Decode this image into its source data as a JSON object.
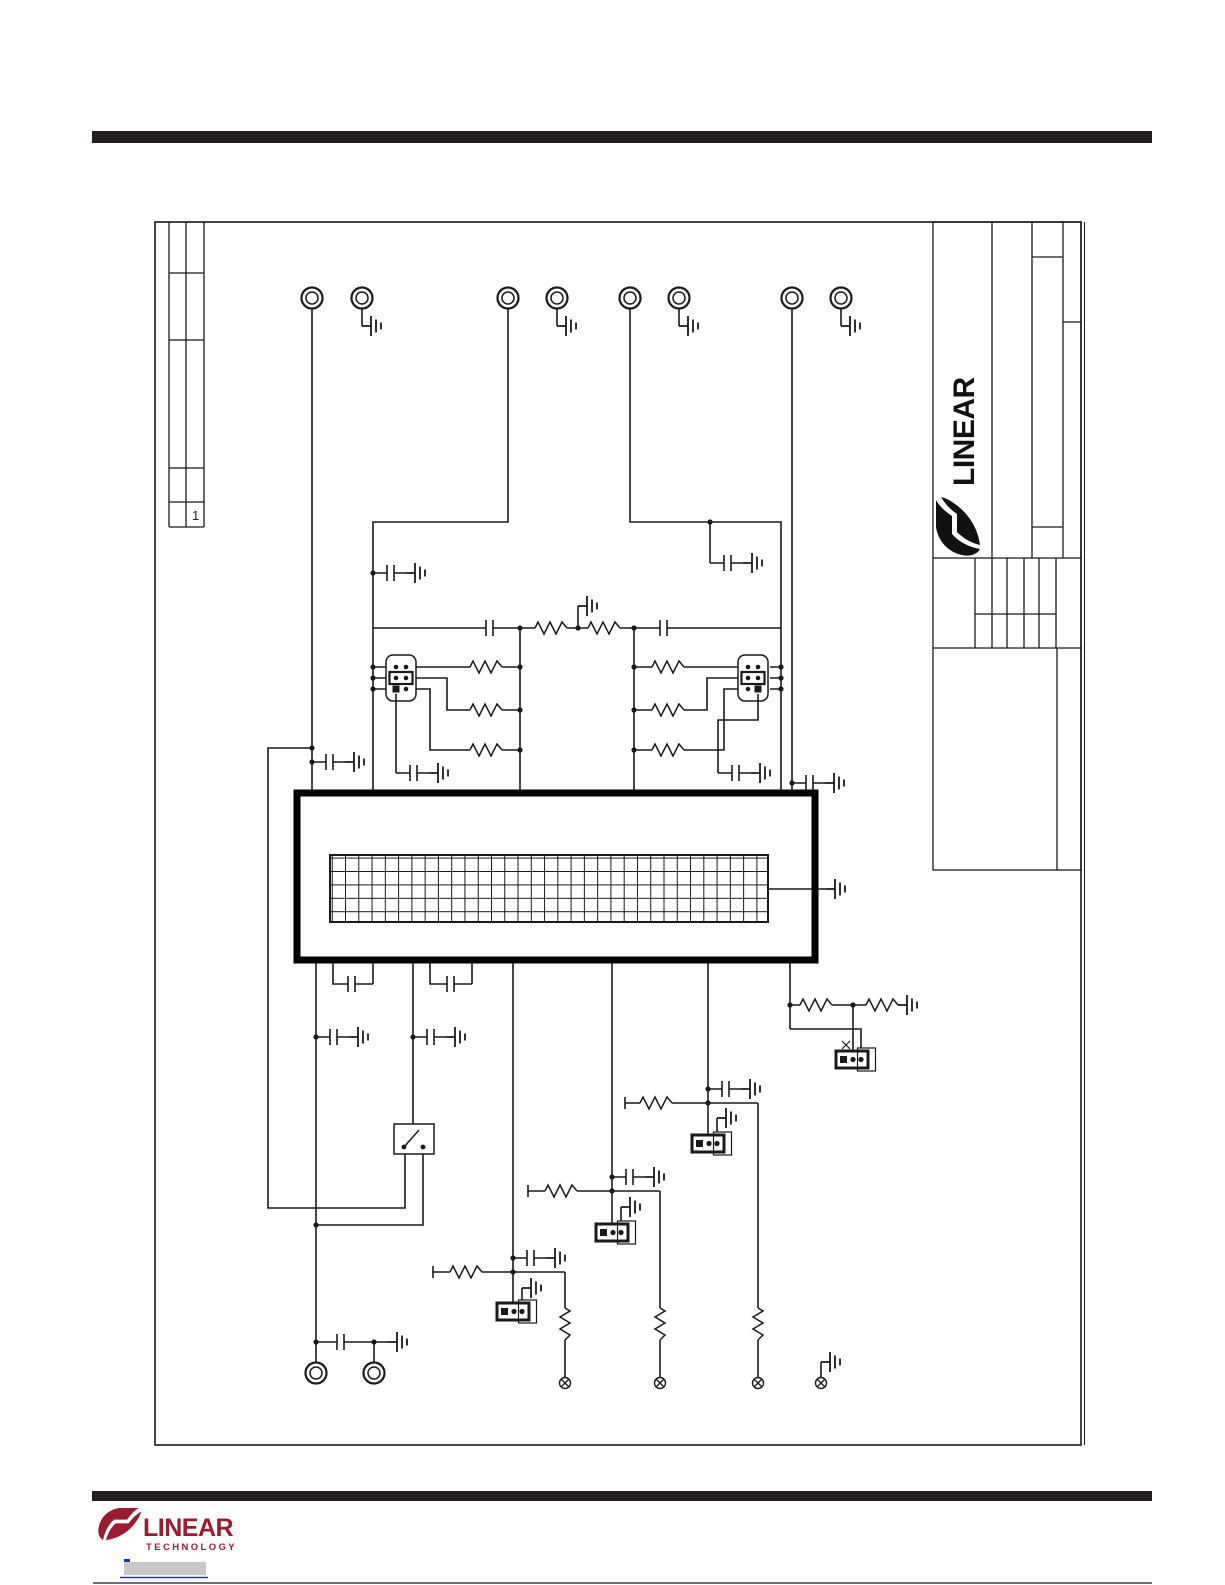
{
  "colors": {
    "line": "#1a1a1a",
    "bar": "#231f20",
    "logo_red": "#9a1c31",
    "link_fill": "#c9c9c9",
    "link_blue": "#2233cc",
    "paper": "#ffffff"
  },
  "title_block": {
    "brand_vertical": "LINEAR"
  },
  "revision_table": {
    "sheet_number": "1"
  },
  "footer": {
    "brand": "LINEAR",
    "brand_sub": "TECHNOLOGY"
  },
  "schematic": {
    "top_turrets": 8,
    "bottom_turrets": 2,
    "test_points": 4,
    "ic_grid": {
      "columns": 33,
      "rows": 5
    },
    "jumper_headers_2x3": 2,
    "jumper_headers_3pin": 4,
    "switches": 1,
    "capacitors": 16,
    "resistors": 16,
    "grounds": 20
  }
}
